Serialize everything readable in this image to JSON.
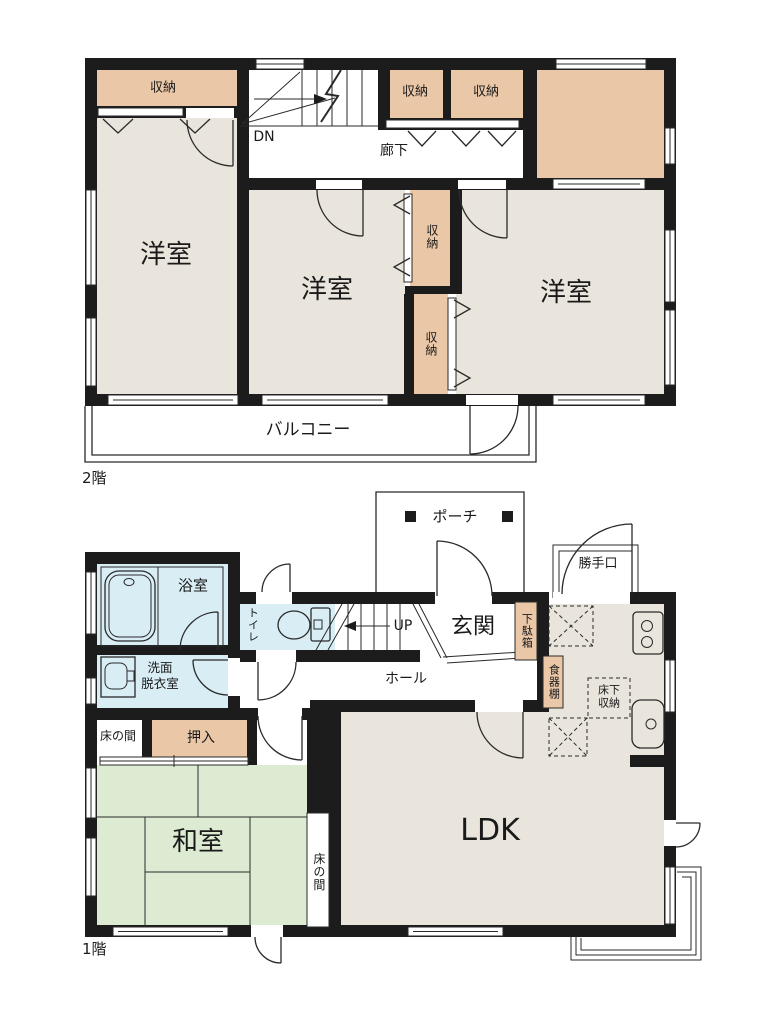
{
  "colors": {
    "wall": "#1c1c1c",
    "floor": "#e9e5dc",
    "closet": "#eac7a7",
    "tatami": "#dcebd1",
    "wet": "#d9edf5",
    "line": "#2a2a2a",
    "paper": "#ffffff"
  },
  "f2": {
    "floor_label": "2階",
    "closet_tl": "収納",
    "closet_a": "収納",
    "closet_b": "収納",
    "closet_mid_upper": "収納",
    "closet_mid_lower": "収納",
    "stairs_dn": "DN",
    "corridor": "廊下",
    "room_left": "洋室",
    "room_mid": "洋室",
    "room_right": "洋室",
    "balcony": "バルコニー"
  },
  "f1": {
    "floor_label": "1階",
    "porch": "ポーチ",
    "back_door": "勝手口",
    "bath": "浴室",
    "washroom_line1": "洗面",
    "washroom_line2": "脱衣室",
    "toilet": "トイレ",
    "stairs_up": "UP",
    "entrance": "玄関",
    "shoe_cabinet": "下駄箱",
    "hall": "ホール",
    "cupboard": "食器棚",
    "underfloor_line1": "床下",
    "underfloor_line2": "収納",
    "tokonoma_front": "床の間",
    "closet_oshiire": "押入",
    "japanese_room": "和室",
    "tokonoma_side": "床の間",
    "ldk": "LDK"
  }
}
